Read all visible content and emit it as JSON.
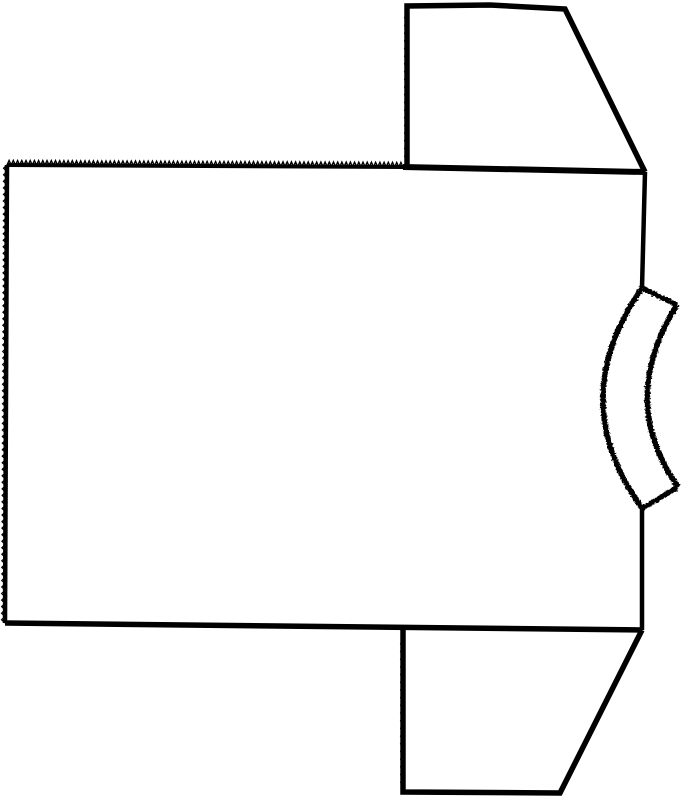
{
  "drawing": {
    "width": 687,
    "height": 800,
    "background": "#ffffff",
    "ink": "#000000",
    "shapes": [
      {
        "name": "top-sleeve-outline",
        "group": "main",
        "type": "polyline",
        "points": [
          [
            407,
            166
          ],
          [
            407,
            6
          ],
          [
            490,
            5
          ],
          [
            565,
            9
          ],
          [
            645,
            172
          ]
        ],
        "stroke_width": 5.5
      },
      {
        "name": "top-sleeve-left-serration",
        "group": "main",
        "type": "serration",
        "from": [
          407,
          14
        ],
        "to": [
          407,
          160
        ],
        "amp": -2.4,
        "spacing": 7.5,
        "tooth_stroke": 1.3
      },
      {
        "name": "body-top-edge-serrated",
        "group": "main",
        "type": "serrated-line",
        "from": [
          7,
          165
        ],
        "to": [
          403,
          167
        ],
        "amp": 4.6,
        "spacing": 4.2,
        "base_width": 4,
        "tooth_stroke": 1.4
      },
      {
        "name": "body-shoulder-line",
        "group": "main",
        "type": "polyline",
        "points": [
          [
            403,
            167
          ],
          [
            645,
            172
          ]
        ],
        "stroke_width": 6
      },
      {
        "name": "body-left-edge-serrated",
        "group": "main",
        "type": "serrated-line",
        "from": [
          7,
          165
        ],
        "to": [
          5,
          623
        ],
        "amp": -3.4,
        "spacing": 6.5,
        "base_width": 4.5,
        "tooth_stroke": 1.3
      },
      {
        "name": "body-bottom-edge",
        "group": "main",
        "type": "polyline",
        "points": [
          [
            5,
            623
          ],
          [
            642,
            630
          ]
        ],
        "stroke_width": 5.5
      },
      {
        "name": "body-right-edge-upper",
        "group": "main",
        "type": "polyline",
        "points": [
          [
            645,
            172
          ],
          [
            642,
            288
          ]
        ],
        "stroke_width": 4.5
      },
      {
        "name": "body-right-edge-lower",
        "group": "main",
        "type": "polyline",
        "points": [
          [
            642,
            508
          ],
          [
            642,
            630
          ]
        ],
        "stroke_width": 4.5
      },
      {
        "name": "bottom-sleeve-outline",
        "group": "main",
        "type": "polyline",
        "points": [
          [
            403,
            629
          ],
          [
            403,
            792
          ],
          [
            560,
            793
          ],
          [
            642,
            630
          ]
        ],
        "stroke_width": 5.5
      },
      {
        "name": "bottom-sleeve-left-serration",
        "group": "main",
        "type": "serration",
        "from": [
          403,
          640
        ],
        "to": [
          403,
          786
        ],
        "amp": -2.4,
        "spacing": 7.5,
        "tooth_stroke": 1.3
      },
      {
        "name": "collar-top-cap",
        "group": "collar",
        "type": "polyline",
        "points": [
          [
            642,
            288
          ],
          [
            677,
            305
          ]
        ],
        "stroke_width": 5
      },
      {
        "name": "collar-outer-arc",
        "group": "collar",
        "type": "quad",
        "from": [
          677,
          305
        ],
        "ctrl": [
          617,
          400
        ],
        "to": [
          678,
          487
        ],
        "stroke_width": 5.5
      },
      {
        "name": "collar-inner-arc",
        "group": "collar",
        "type": "quad",
        "from": [
          642,
          288
        ],
        "ctrl": [
          564,
          400
        ],
        "to": [
          642,
          508
        ],
        "stroke_width": 5.5
      },
      {
        "name": "collar-bottom-cap",
        "group": "collar",
        "type": "polyline",
        "points": [
          [
            678,
            487
          ],
          [
            643,
            508
          ]
        ],
        "stroke_width": 5
      }
    ]
  }
}
